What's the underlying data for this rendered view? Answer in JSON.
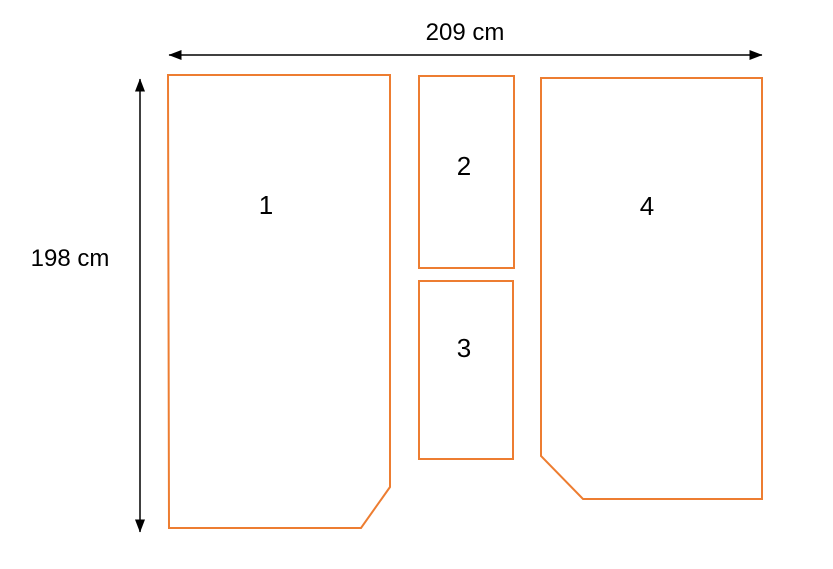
{
  "diagram": {
    "type": "cutting-layout-diagram",
    "dimension_width": {
      "label": "209 cm"
    },
    "dimension_height": {
      "label": "198 cm"
    },
    "panels": [
      {
        "label": "1",
        "shape": "rectangle-with-clipped-bottom-right-corner"
      },
      {
        "label": "2",
        "shape": "rectangle"
      },
      {
        "label": "3",
        "shape": "rectangle"
      },
      {
        "label": "4",
        "shape": "rectangle-with-clipped-bottom-left-corner"
      }
    ],
    "colors": {
      "panel_outline": "#ED7D31",
      "dimension_line": "#000000",
      "text": "#000000",
      "background": "#FFFFFF"
    }
  }
}
